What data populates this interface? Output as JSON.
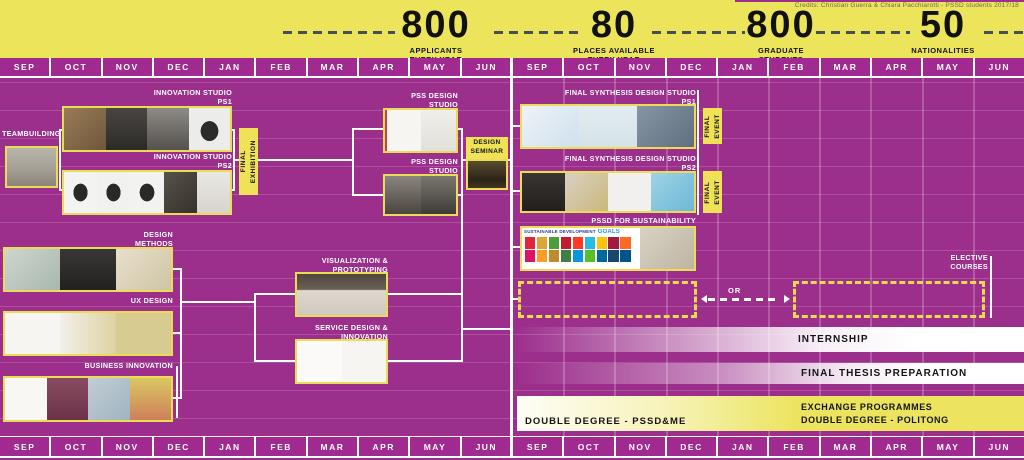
{
  "credits": "Credits: Christian Guerra & Chiara Pacchiarotti - PSSD students 2017/18",
  "stats": [
    {
      "value": "800",
      "label": "APPLICANTS\nEVERY YEAR"
    },
    {
      "value": "80",
      "label": "PLACES AVAILABLE\nEVERY YEAR"
    },
    {
      "value": "800",
      "label": "GRADUATE\nSTUDENTS"
    },
    {
      "value": "50",
      "label": "NATIONALITIES"
    }
  ],
  "months": [
    "SEP",
    "OCT",
    "NOV",
    "DEC",
    "JAN",
    "FEB",
    "MAR",
    "APR",
    "MAY",
    "JUN",
    "SEP",
    "OCT",
    "NOV",
    "DEC",
    "JAN",
    "FEB",
    "MAR",
    "APR",
    "MAY",
    "JUN"
  ],
  "colors": {
    "background": "#9c2f8c",
    "banner_yellow": "#ece55c",
    "block_yellow": "#f0e256",
    "dash_dark": "#454f5a",
    "month_purple": "#a12a90",
    "white": "#ffffff"
  },
  "year1": {
    "teambuilding": {
      "label": "TEAMBUILDING",
      "tiles": [
        "linear-gradient(180deg,#bab5ac 0%,#a39d93 60%,#89837a 100%)"
      ]
    },
    "innovation_studio_ps1": {
      "label": "INNOVATION STUDIO\nPS1",
      "tiles": [
        "linear-gradient(135deg,#9a7c55,#6e573c)",
        "linear-gradient(180deg,#4a4642,#2c2a28)",
        "linear-gradient(180deg,#8e8a86,#55514d)",
        "radial-gradient(ellipse at 50% 55%,#2e2c2a 0 30%,#ececea 31%)"
      ]
    },
    "innovation_studio_ps2": {
      "label": "INNOVATION STUDIO\nPS2",
      "tiles": [
        "radial-gradient(ellipse at 50% 50%,#2b2926 0 30%,#f3f3f1 31%)",
        "radial-gradient(ellipse at 50% 50%,#2b2926 0 30%,#f1f1ef 31%)",
        "radial-gradient(ellipse at 50% 50%,#2b2926 0 30%,#f2f2f0 31%)",
        "linear-gradient(135deg,#57524a,#35312b)",
        "linear-gradient(180deg,#eae8e3,#d7d4cd)"
      ]
    },
    "final_exhibition": {
      "label": "FINAL\nEXHIBITION"
    },
    "pss_design_studio_ps1": {
      "label": "PSS DESIGN STUDIO\nPS1",
      "tiles": [
        "linear-gradient(90deg,#c94040 0 6%,#f6f5f2 6%)",
        "linear-gradient(180deg,#efeee9,#e2e0da)"
      ]
    },
    "pss_design_studio_ps2": {
      "label": "PSS DESIGN STUDIO\nPS2",
      "tiles": [
        "linear-gradient(180deg,#8a857e,#4a463f)",
        "linear-gradient(180deg,#7a766f,#3f3b36)"
      ]
    },
    "design_seminar": {
      "label": "DESIGN\nSEMINAR",
      "photo": [
        "linear-gradient(180deg,#5a4c30 0%,#2c2417 70%,#43361f 100%)"
      ]
    },
    "design_methods": {
      "label": "DESIGN\nMETHODS",
      "tiles": [
        "linear-gradient(135deg,#cdd6cf,#a9b7ad)",
        "linear-gradient(180deg,#3a3836,#232120)",
        "linear-gradient(135deg,#e8e0cc,#cfc4a6)"
      ]
    },
    "ux_design": {
      "label": "UX DESIGN",
      "tiles": [
        "#f6f5f2",
        "linear-gradient(90deg,#f2f0ea,#ded2a2)",
        "#d8cb92"
      ]
    },
    "business_innovation": {
      "label": "BUSINESS INNOVATION",
      "tiles": [
        "#f8f7f4",
        "linear-gradient(180deg,#8a4b60,#6b3349)",
        "linear-gradient(135deg,#c3cdd4,#9fb4c0)",
        "linear-gradient(180deg,#d9c862,#cf7f5a)"
      ]
    },
    "visualization_prototyping": {
      "label": "VISUALIZATION &\nPROTOTYPING",
      "tiles": [
        "linear-gradient(180deg,#4f463e 0%,#6b6157 38%,#ded8cf 40%,#cfc8be 100%)"
      ]
    },
    "service_design_innovation": {
      "label": "SERVICE DESIGN &\nINNOVATION",
      "tiles": [
        "#fbfaf8",
        "#f6f5f2"
      ]
    }
  },
  "year2": {
    "final_synthesis_ps1": {
      "label": "FINAL SYNTHESIS DESIGN STUDIO\nPS1",
      "tiles": [
        "linear-gradient(135deg,#eef3f7,#cfe0ee)",
        "linear-gradient(180deg,#e3ecf0,#d5e2e8)",
        "linear-gradient(135deg,#8795a3,#5f6f80)"
      ]
    },
    "final_event_1": {
      "label": "FINAL\nEVENT"
    },
    "final_synthesis_ps2": {
      "label": "FINAL SYNTHESIS DESIGN STUDIO\nPS2",
      "tiles": [
        "linear-gradient(180deg,#3a3533,#221f1d)",
        "linear-gradient(135deg,#d9d0c5,#cbb878)",
        "#f1f0ee",
        "linear-gradient(135deg,#9fd3e6,#6db7d6)"
      ]
    },
    "final_event_2": {
      "label": "FINAL\nEVENT"
    },
    "pssd_for_sustainability": {
      "label": "PSSD FOR SUSTAINABILITY",
      "sdg_logo_small": "SUSTAINABLE DEVELOPMENT",
      "sdg_logo_big": "GOALS",
      "sdg_colors": [
        "#e5243b",
        "#dda63a",
        "#4c9f38",
        "#c5192d",
        "#ff3a21",
        "#26bde2",
        "#fcc30b",
        "#a21942",
        "#fd6925",
        "#dd1367",
        "#fd9d24",
        "#bf8b2e",
        "#3f7e44",
        "#0a97d9",
        "#56c02b",
        "#00689d",
        "#19486a",
        "#00558b"
      ],
      "photo": [
        "linear-gradient(135deg,#d9d2c4,#beb5a2)"
      ]
    },
    "elective_courses": {
      "label": "ELECTIVE\nCOURSES"
    },
    "or_label": "OR",
    "internship": {
      "label": "INTERNSHIP"
    },
    "final_thesis": {
      "label": "FINAL THESIS PREPARATION"
    },
    "double_degree_left": {
      "label": "DOUBLE DEGREE - PSSD&ME"
    },
    "exchange": {
      "label": "EXCHANGE PROGRAMMES\nDOUBLE DEGREE - POLITONG"
    }
  }
}
